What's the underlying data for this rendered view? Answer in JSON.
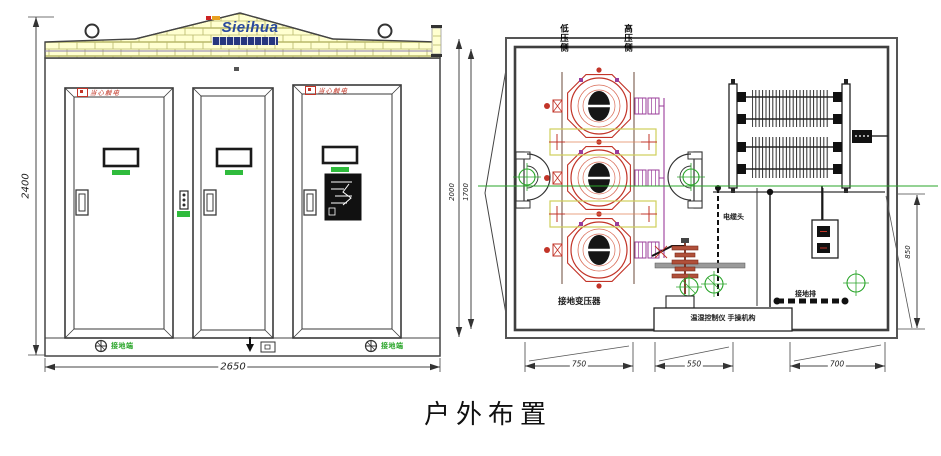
{
  "title": "户外布置",
  "elevation": {
    "brand": "Sieihua",
    "dim_height": "2400",
    "dim_width": "2650",
    "warning_label": "当心触电",
    "ground_label": "接地端"
  },
  "plan": {
    "label_low_voltage_side": "低压侧",
    "label_high_voltage_side": "高压侧",
    "dim_depth_outer": "2000",
    "dim_depth_inner": "1700",
    "dim_right": "850",
    "dim_bottom": [
      "750",
      "550",
      "700"
    ],
    "transformer_label": "接地变压器",
    "cable_label": "电缆头",
    "ground_bar_label": "接地排",
    "controller_label": "温湿控制仪 手操机构"
  },
  "colors": {
    "brick_fill": "#ffffd0",
    "brick_line": "#b9b96a",
    "red": "#c23428",
    "green": "#2aa52a",
    "purple": "#9a3d9a",
    "logo_blue": "#2a4a9e",
    "line": "#444444",
    "wall": "#4a4a4a"
  }
}
